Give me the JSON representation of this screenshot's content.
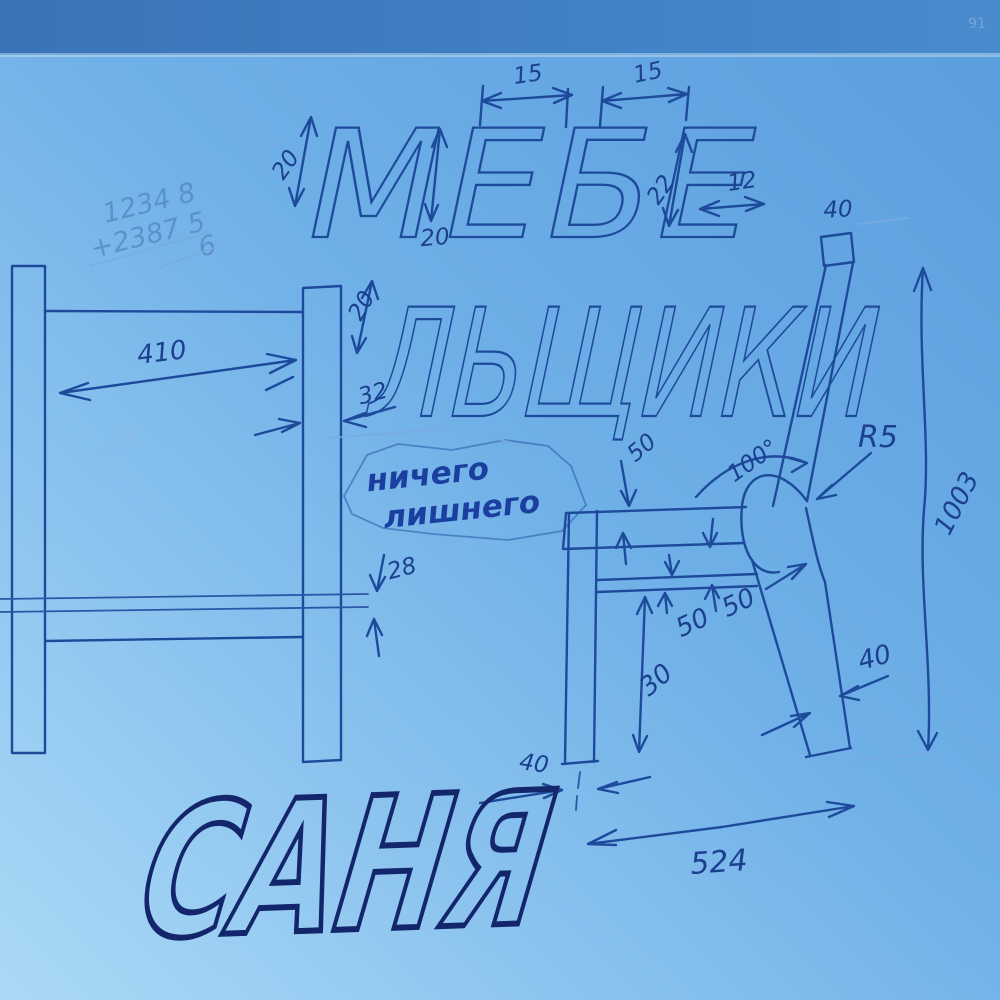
{
  "lettering": {
    "line1": "МЕБЕ",
    "line2": "ЛЬЩИКИ",
    "signature": "САНЯ"
  },
  "note_bubble": {
    "line1": "ничего",
    "line2": "лишнего"
  },
  "math_scribble": {
    "line1": "1234 8",
    "line2": "+2387 5",
    "line3": "6"
  },
  "corner_mark": "91",
  "dimensions": {
    "m_stroke": "20",
    "e_height": "20",
    "e_width": "15",
    "b_width": "15",
    "e2_height": "22",
    "e2_width": "12",
    "l_stroke": "20",
    "back_post_top": "40",
    "frame_width": "410",
    "post_width": "32",
    "rail_thickness": "28",
    "seat_inset": "50",
    "seat_angle": "100°",
    "back_radius": "R5",
    "rail_gap_a": "50",
    "rail_gap_b": "50",
    "rail_drop": "30",
    "back_leg_width": "40",
    "overall_height": "1003",
    "front_leg_width": "40",
    "seat_depth": "524"
  },
  "colors": {
    "table": "#3c7bbd",
    "paper_top": "#5ea4e0",
    "paper_bottom": "#a9d8f5",
    "ink": "#1e4a9c",
    "dark_ink": "#14266b",
    "pencil": "#78abde"
  }
}
